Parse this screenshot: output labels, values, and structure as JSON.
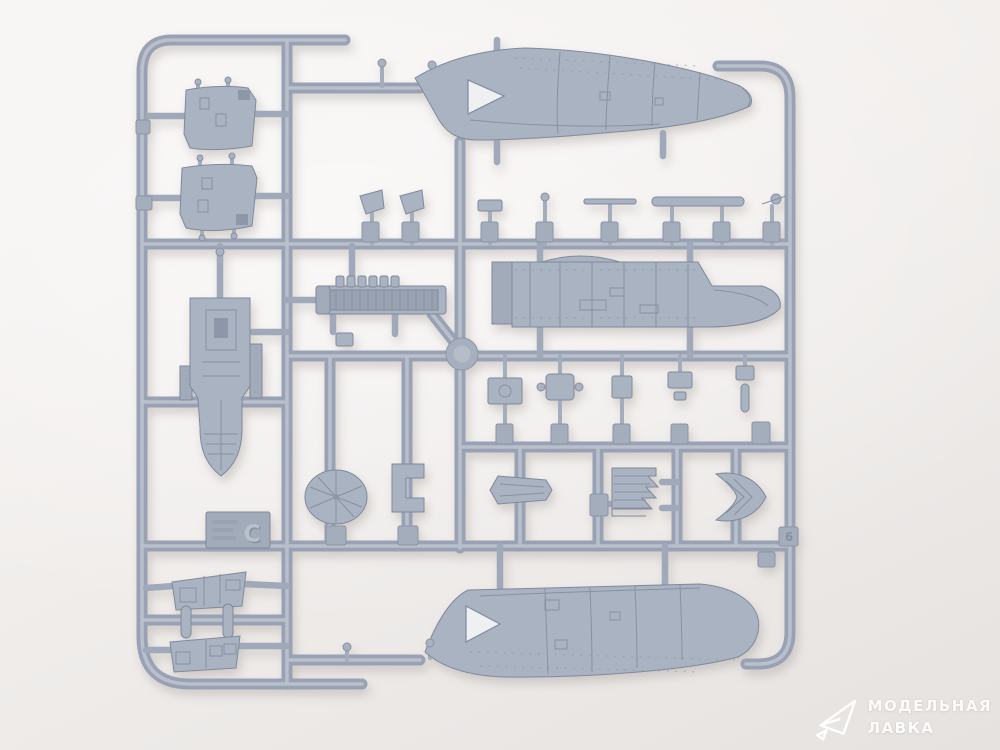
{
  "photo": {
    "subject": "Injection-molded polystyrene sprue (runner frame) with aircraft model kit parts, photographed on a white background",
    "background_color": "#f2efed",
    "plastic_color": "#a9b2c1",
    "plastic_shadow_color": "#7f8a9c",
    "plastic_highlight_color": "#bec5d0"
  },
  "sprue": {
    "sprue_letter": "C",
    "frame_tag_number": "6",
    "parts": [
      {
        "id": "upper-fuselage-half",
        "label": "Long fuselage half with engraved panel lines and triangular cockpit cut-out (top of sprue)"
      },
      {
        "id": "lower-fuselage-half",
        "label": "Matching long fuselage half with triangular cut-out (bottom of sprue)"
      },
      {
        "id": "fuselage-side-panel",
        "label": "Horizontal fuselage side section with teardrop blister and canopy opening (middle right)"
      },
      {
        "id": "canopy-hatch-panel-1",
        "label": "Curved rectangular hatch/panel (upper left)"
      },
      {
        "id": "canopy-hatch-panel-2",
        "label": "Curved rectangular hatch/panel (upper left, second)"
      },
      {
        "id": "cockpit-tub",
        "label": "Vertical cockpit tub with side consoles and pointed lower end (left middle)"
      },
      {
        "id": "engine-bay-block",
        "label": "Ribbed engine/gun-bay block with exhaust stubs (center)"
      },
      {
        "id": "spinner-disc",
        "label": "Conical disc / spinner backplate with centre hole"
      },
      {
        "id": "c-clamp-part",
        "label": "C-shaped bracket part"
      },
      {
        "id": "small-wing-part",
        "label": "Small tapered wing/stabilizer part"
      },
      {
        "id": "finned-radial-part",
        "label": "Stepped fir-tree shaped part with side gates"
      },
      {
        "id": "v-intake-part",
        "label": "Arrowhead / V-shaped intake part"
      },
      {
        "id": "flap-panel-1",
        "label": "Trapezoid flap/door panel (bottom left, upper)"
      },
      {
        "id": "flap-panel-2",
        "label": "Trapezoid flap/door panel (bottom left, lower)"
      },
      {
        "id": "actuator-pills",
        "label": "Two small capsule-shaped actuator parts between the flap panels"
      },
      {
        "id": "small-parts-rows",
        "label": "Rows of small parts on numbered tags: antenna masts, pitot tube, long rod, brackets, panels"
      },
      {
        "id": "info-tag",
        "label": "Molded rectangular information tag with faint raised text and sprue letter"
      }
    ]
  },
  "watermark": {
    "line1": "МОДЕЛЬНАЯ",
    "line2": "ЛАВКА",
    "logo": "paper-plane-outline",
    "color": "#ffffff"
  }
}
